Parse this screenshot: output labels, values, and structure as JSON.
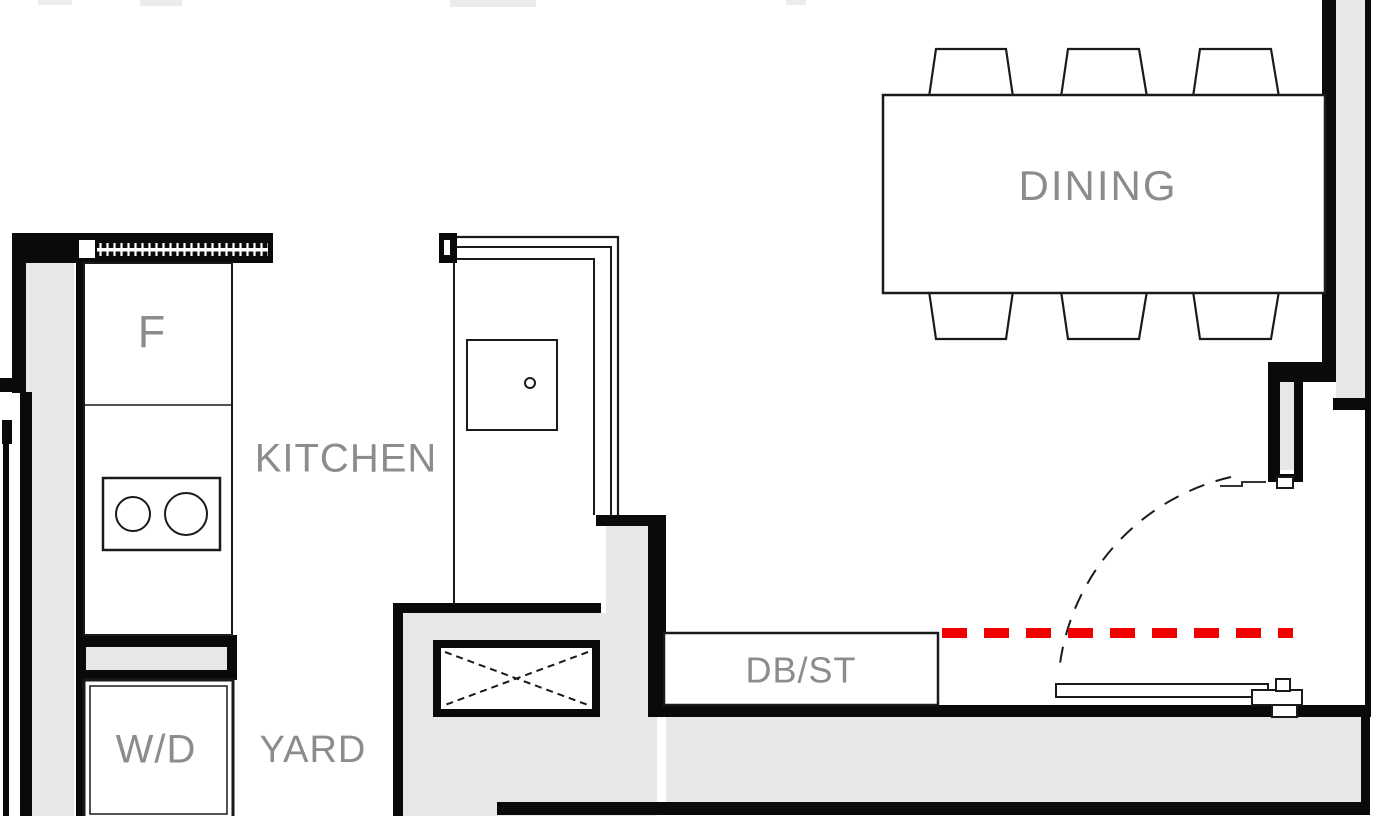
{
  "colors": {
    "background": "#ffffff",
    "wall_fill_gray": "#e7e7e7",
    "wall_black": "#0a0a0a",
    "label_gray": "#8c8c8c",
    "annotation_red": "#f10000"
  },
  "rooms": {
    "kitchen": "KITCHEN",
    "dining": "DINING",
    "yard": "YARD"
  },
  "fixtures": {
    "fridge": "F",
    "washer_dryer": "W/D",
    "db_st": "DB/ST"
  }
}
